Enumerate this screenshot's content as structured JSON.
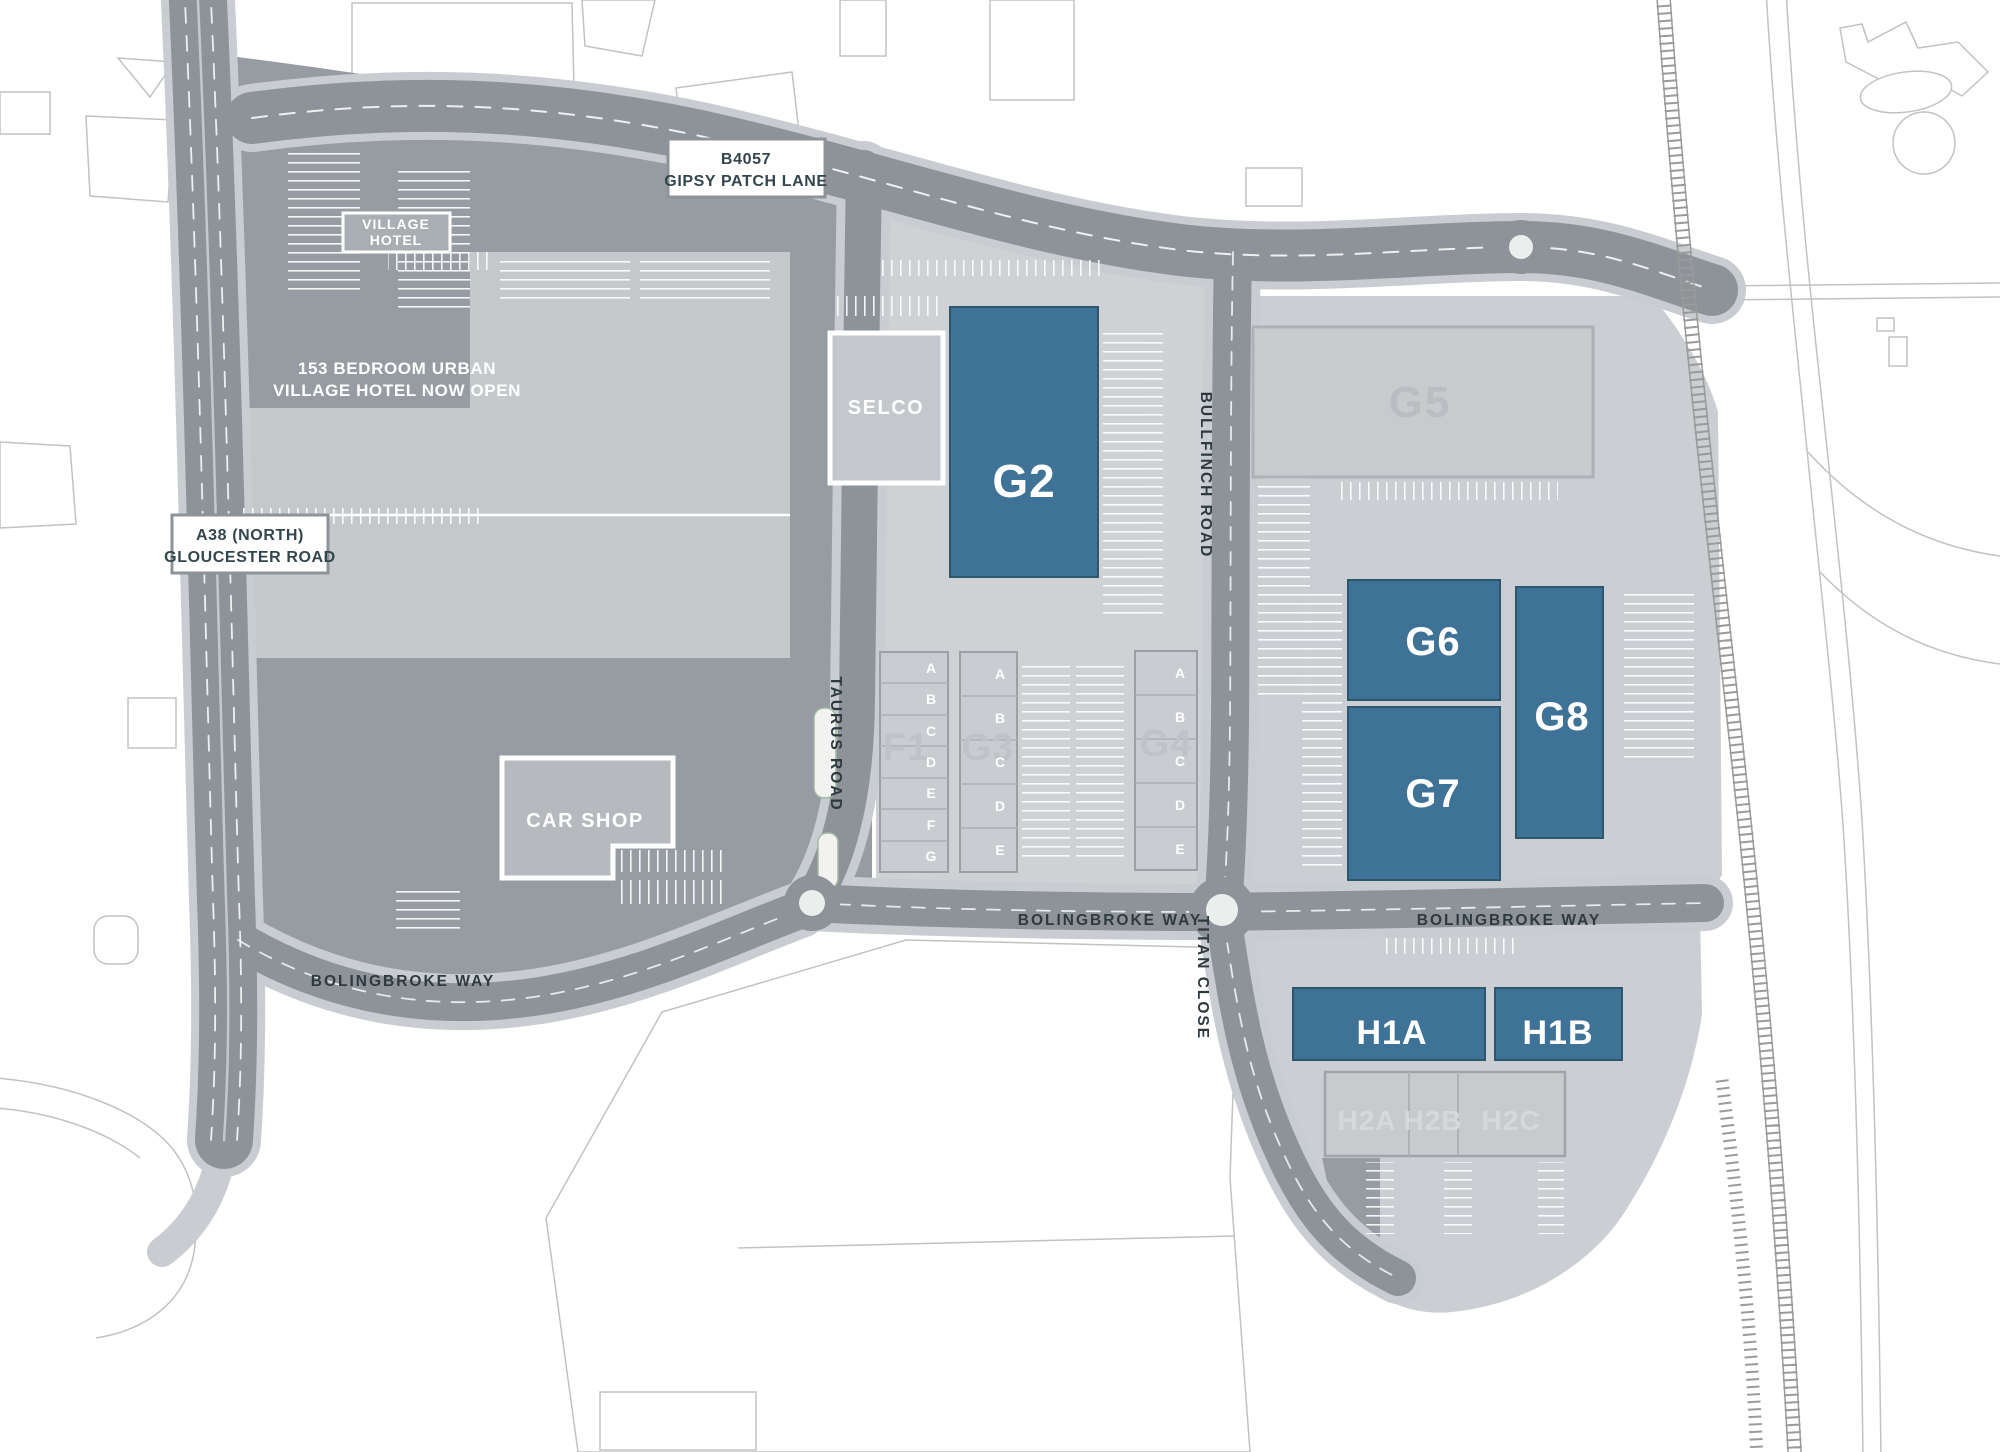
{
  "signs": {
    "gipsy_patch": {
      "line1": "B4057",
      "line2": "GIPSY PATCH LANE"
    },
    "a38": {
      "line1": "A38 (NORTH)",
      "line2": "GLOUCESTER ROAD"
    },
    "village_hotel": {
      "line1": "VILLAGE",
      "line2": "HOTEL"
    },
    "hotel_banner": {
      "line1": "153 BEDROOM URBAN",
      "line2": "VILLAGE HOTEL NOW OPEN"
    }
  },
  "road_labels": {
    "bolingbroke_west": "BOLINGBROKE WAY",
    "bolingbroke_mid": "BOLINGBROKE WAY",
    "bolingbroke_east": "BOLINGBROKE WAY",
    "taurus": "TAURUS ROAD",
    "bullfinch": "BULLFINCH ROAD",
    "titan": "TITAN CLOSE"
  },
  "buildings": {
    "selco": {
      "label": "SELCO"
    },
    "car_shop": {
      "label": "CAR SHOP"
    },
    "g2": {
      "label": "G2"
    },
    "g5": {
      "label": "G5"
    },
    "g6": {
      "label": "G6"
    },
    "g7": {
      "label": "G7"
    },
    "g8": {
      "label": "G8"
    },
    "h1a": {
      "label": "H1A"
    },
    "h1b": {
      "label": "H1B"
    },
    "f1": {
      "label": "F1",
      "units": [
        "A",
        "B",
        "C",
        "D",
        "E",
        "F",
        "G"
      ]
    },
    "g3": {
      "label": "G3",
      "units": [
        "A",
        "B",
        "C",
        "D",
        "E"
      ]
    },
    "g4": {
      "label": "G4",
      "units": [
        "A",
        "B",
        "C",
        "D",
        "E"
      ]
    },
    "h2": {
      "units": [
        "H2A",
        "H2B",
        "H2C"
      ]
    }
  },
  "colors": {
    "highlight_blue": "#3E7296",
    "road_gray": "#8D9399",
    "site_gray": "#979CA2",
    "parcel_gray": "#CBCED2",
    "building_gray": "#C7CACE",
    "sign_text": "#33464D"
  }
}
